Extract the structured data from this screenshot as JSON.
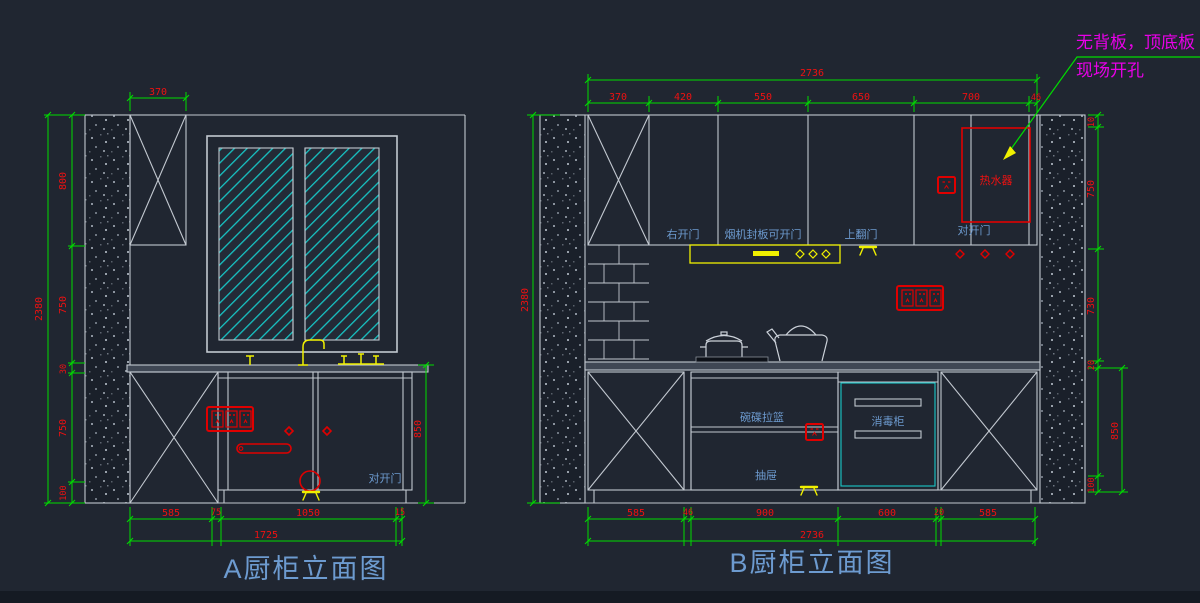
{
  "note": {
    "line1": "无背板，顶底板",
    "line2": "现场开孔"
  },
  "titles": {
    "a": "A厨柜立面图",
    "b": "B厨柜立面图"
  },
  "colors": {
    "background": "#202631",
    "dim_line": "#00dc00",
    "dim_text": "#ee1111",
    "outline": "#c2c8d0",
    "label_blue": "#6d9bd0",
    "hatch_cyan": "#17c3c3",
    "accent_yellow": "#f0f000",
    "note_magenta": "#e800e8",
    "symbol_red": "#e00000"
  },
  "a": {
    "dim_top": "370",
    "left": {
      "overall": "2380",
      "seg": [
        "800",
        "750",
        "30",
        "750",
        "100"
      ]
    },
    "right_height": "850",
    "bottom": {
      "overall": "1725",
      "seg": [
        "585",
        "75",
        "1050",
        "15"
      ]
    },
    "door_label": "对开门"
  },
  "b": {
    "top": {
      "overall": "2736",
      "seg": [
        "370",
        "420",
        "550",
        "650",
        "700",
        "46"
      ]
    },
    "bottom": {
      "overall": "2736",
      "seg": [
        "585",
        "46",
        "900",
        "600",
        "20",
        "585"
      ]
    },
    "left_overall": "2380",
    "right_seg": [
      "10",
      "750",
      "730",
      "20",
      "850",
      "100"
    ],
    "labels": {
      "right_door": "右开门",
      "hood_panel": "烟机封板可开门",
      "flip_door": "上翻门",
      "double_door_top": "对开门",
      "water_heater": "热水器",
      "dish_basket": "碗碟拉篮",
      "drawer": "抽屉",
      "sterilizer": "消毒柜"
    }
  }
}
